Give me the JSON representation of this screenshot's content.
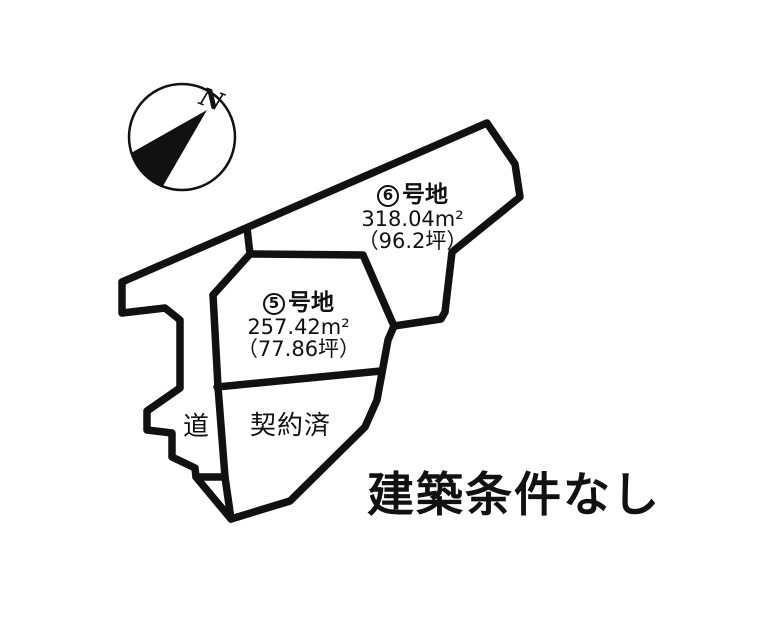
{
  "diagram": {
    "note": "建築条件なし",
    "compass_label": "N",
    "road_label": "道",
    "contracted_label": "契約済",
    "parcel6": {
      "num": "6",
      "suffix": "号地",
      "area": "318.04m²",
      "tsubo": "（96.2坪）"
    },
    "parcel5": {
      "num": "5",
      "suffix": "号地",
      "area": "257.42m²",
      "tsubo": "（77.86坪）"
    }
  },
  "colors": {
    "line": "#111111",
    "background": "#ffffff"
  }
}
